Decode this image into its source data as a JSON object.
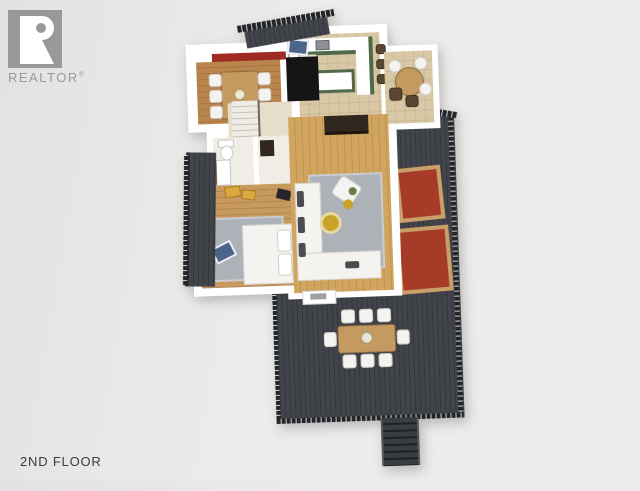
{
  "watermark": {
    "logo_text": "REALTOR",
    "registered_mark": "®"
  },
  "caption": {
    "floor_label": "2ND FLOOR"
  },
  "colors": {
    "background_a": "#e3e2e0",
    "background_b": "#edecea",
    "logo_gray": "#9a9998",
    "caption_text": "#3a3a3a",
    "wall_white": "#ffffff",
    "deck": "#41444a",
    "deck_plank": "#33363b",
    "railing": "#232528",
    "wood_living": "#d2a55e",
    "wood_dining": "#b9854d",
    "wood_bedroom": "#c89a5e",
    "tile_kitchen": "#d9c8a5",
    "cabinet_green": "#4f694a",
    "accent_wall_red": "#9e2a23",
    "rug_gray": "#adb2b8",
    "rug_red": "#a63b28",
    "rug_red_border": "#c9a06a",
    "furniture_white": "#f4f3f0",
    "table_wood": "#c59a60",
    "dark_furniture": "#32271e",
    "stairwell_black": "#151515",
    "art_blue": "#4b648c",
    "accent_yellow": "#d9a83e",
    "gold": "#c9a227",
    "hall_floor": "#e6decb",
    "bath_floor": "#f0ede7"
  }
}
